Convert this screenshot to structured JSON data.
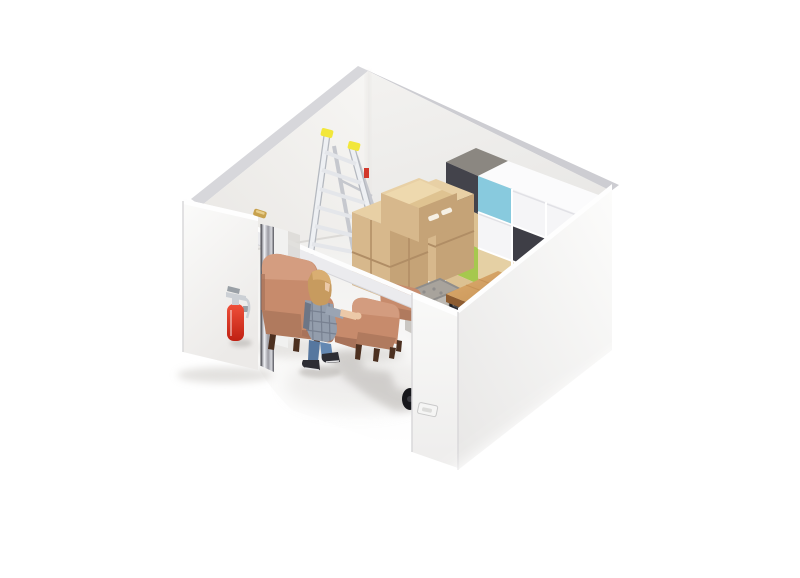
{
  "scene": {
    "type": "3d-isometric-render",
    "subject": "Cutaway view of a white self-storage unit containing furniture and moving goods",
    "objects": [
      "back-left-wall",
      "back-right-wall",
      "front-left-wall",
      "front-right-wall",
      "open-door",
      "door-hinge",
      "fire-extinguisher",
      "step-ladder",
      "cardboard-box-stack",
      "cube-shelving-unit",
      "wooden-side-table",
      "dark-storage-bin",
      "wire-mesh-cage",
      "large-armchair",
      "small-armchair",
      "inner-armchair",
      "person-reaching",
      "floor",
      "cast-shadows",
      "trolley-wheel",
      "door-latch",
      "opening-header-beam"
    ]
  },
  "colors": {
    "bg": "#ffffff",
    "white": "#ffffff",
    "rim": "#d7d7db",
    "rim2": "#cdcdd2",
    "corner": "#e5e3e0",
    "wall_in_1": "#f7f6f4",
    "wall_in_2": "#e9e7e4",
    "wall_in_3": "#f3f2f0",
    "wall_in_4": "#e6e5e3",
    "floor_1": "#efeeec",
    "floor_2": "#fafaf8",
    "apron_1": "#f1f0ee",
    "apron_2": "#ffffff",
    "skirt": "#dcdad7",
    "shadow": "#c7c4c0",
    "shadow_dark": "#b2afab",
    "ladder_rail": "#eef0f3",
    "ladder_edge": "#b4b8bf",
    "ladder_rear": "#c6c8ce",
    "ladder_rung": "#e4e6ea",
    "ladder_cap": "#f2e73b",
    "ladder_sticker": "#d2382b",
    "ladder_foot": "#9aa0a7",
    "box_top": "#e8d0a5",
    "box_left": "#d7b88c",
    "box_right": "#c5a377",
    "box_seam": "#b08d65",
    "box_flap": "#eed9ae",
    "box_flap2": "#dfc391",
    "box_slot": "#f6f0e4",
    "shelf_top_dark": "#8b8781",
    "shelf_top_white": "#fbfbfc",
    "shelf_dark": "#43434b",
    "shelf_dark2": "#3e3e46",
    "shelf_wood": "#dcc192",
    "shelf_wood2": "#e5d0a4",
    "shelf_green": "#a6c84e",
    "shelf_blue": "#88cade",
    "shelf_open": "#f5f5f7",
    "shelf_inner": "#dddde2",
    "shelf_line": "#ffffff",
    "cage_frame": "#8f8d8b",
    "cage_top": "#a8a39c",
    "cage_mesh1": "#cac7c2",
    "cage_mesh2": "#bcb8b2",
    "cage_line": "#a2a099",
    "bin_dark": "#2e2e34",
    "bin_light": "#8e9096",
    "bin_top": "#3c3c42",
    "wood_1": "#dcab6e",
    "wood_2": "#bf8a4c",
    "wood_edge": "#8d5c31",
    "wood_edge2": "#9c6636",
    "table_leg": "#1e1e22",
    "chair_main": "#c78b6c",
    "chair_light": "#d6a084",
    "chair_dark": "#b07a5e",
    "chair_deep": "#a8735a",
    "chair_leg": "#4c3020",
    "person_hair": "#c79b5f",
    "person_hair2": "#dab074",
    "person_skin": "#ecc9a8",
    "person_shirt": "#939dac",
    "person_shirt_dark": "#6d7686",
    "person_arm": "#9aa4b3",
    "person_jeans1": "#56779f",
    "person_jeans2": "#6488b2",
    "person_shoe": "#2d2d33",
    "person_sole": "#e3e3e5",
    "ext_red1": "#f0503a",
    "ext_red2": "#bf2012",
    "ext_silver": "#ccd0d5",
    "ext_gray": "#9aa0a6",
    "chrome_1": "#63636a",
    "chrome_2": "#eff0f4",
    "chrome_3": "#9b9ba3",
    "chrome_4": "#d8d9de",
    "chrome_5": "#55555c",
    "hinge_gold": "#c8a24e",
    "hinge_gold2": "#e7cd8a",
    "jamb": "#f1f1f0",
    "door_shade": "#dcdad7",
    "beam_top": "#fdfdfd",
    "beam_face": "#ebebee",
    "beam_edge": "#d6d6da",
    "wallFR_1": "#fcfcfb",
    "wallFR_2": "#e8e7e6",
    "panel_1": "#f9f9f8",
    "panel_2": "#eeedec",
    "wallrim_white": "#fefefe",
    "wall_edge": "#d9d8da",
    "wallFL_1": "#fbfbfa",
    "wallFL_2": "#eceae8",
    "latch_face": "#f5f5f4",
    "latch_slot": "#dcdcda",
    "wheel": "#17171b",
    "wheel_hub": "#3a3a40"
  }
}
